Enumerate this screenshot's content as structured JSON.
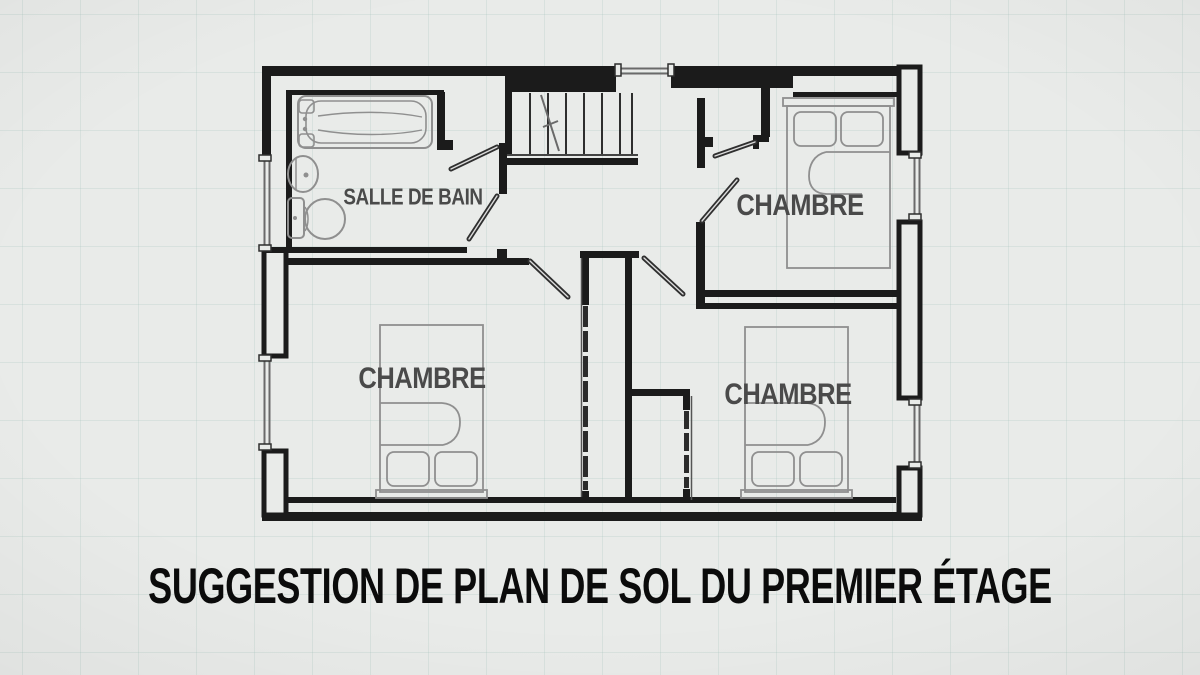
{
  "title": "SUGGESTION DE PLAN DE SOL DU PREMIER ÉTAGE",
  "plan": {
    "rooms": [
      {
        "id": "bathroom",
        "label": "SALLE DE BAIN"
      },
      {
        "id": "bedroom_top_right",
        "label": "CHAMBRE"
      },
      {
        "id": "bedroom_bottom_left",
        "label": "CHAMBRE"
      },
      {
        "id": "bedroom_bottom_right",
        "label": "CHAMBRE"
      }
    ],
    "fixtures": [
      {
        "type": "bathtub",
        "room": "bathroom"
      },
      {
        "type": "sink",
        "room": "bathroom"
      },
      {
        "type": "toilet",
        "room": "bathroom"
      },
      {
        "type": "staircase",
        "location": "hallway"
      },
      {
        "type": "double-bed",
        "room": "bedroom_top_right"
      },
      {
        "type": "double-bed",
        "room": "bedroom_bottom_left"
      },
      {
        "type": "double-bed",
        "room": "bedroom_bottom_right"
      },
      {
        "type": "closet-bifold",
        "room": "bedroom_bottom_left"
      },
      {
        "type": "closet-bifold",
        "room": "bedroom_bottom_right"
      },
      {
        "type": "closet",
        "room": "bedroom_top_right"
      }
    ],
    "colors": {
      "background": "#e9ebe9",
      "grid": "#ccd8d4",
      "wall": "#1b1b1b",
      "furniture": "#8f8f8f",
      "room_label": "#4a4a4a",
      "title": "#0b0b0b"
    }
  }
}
